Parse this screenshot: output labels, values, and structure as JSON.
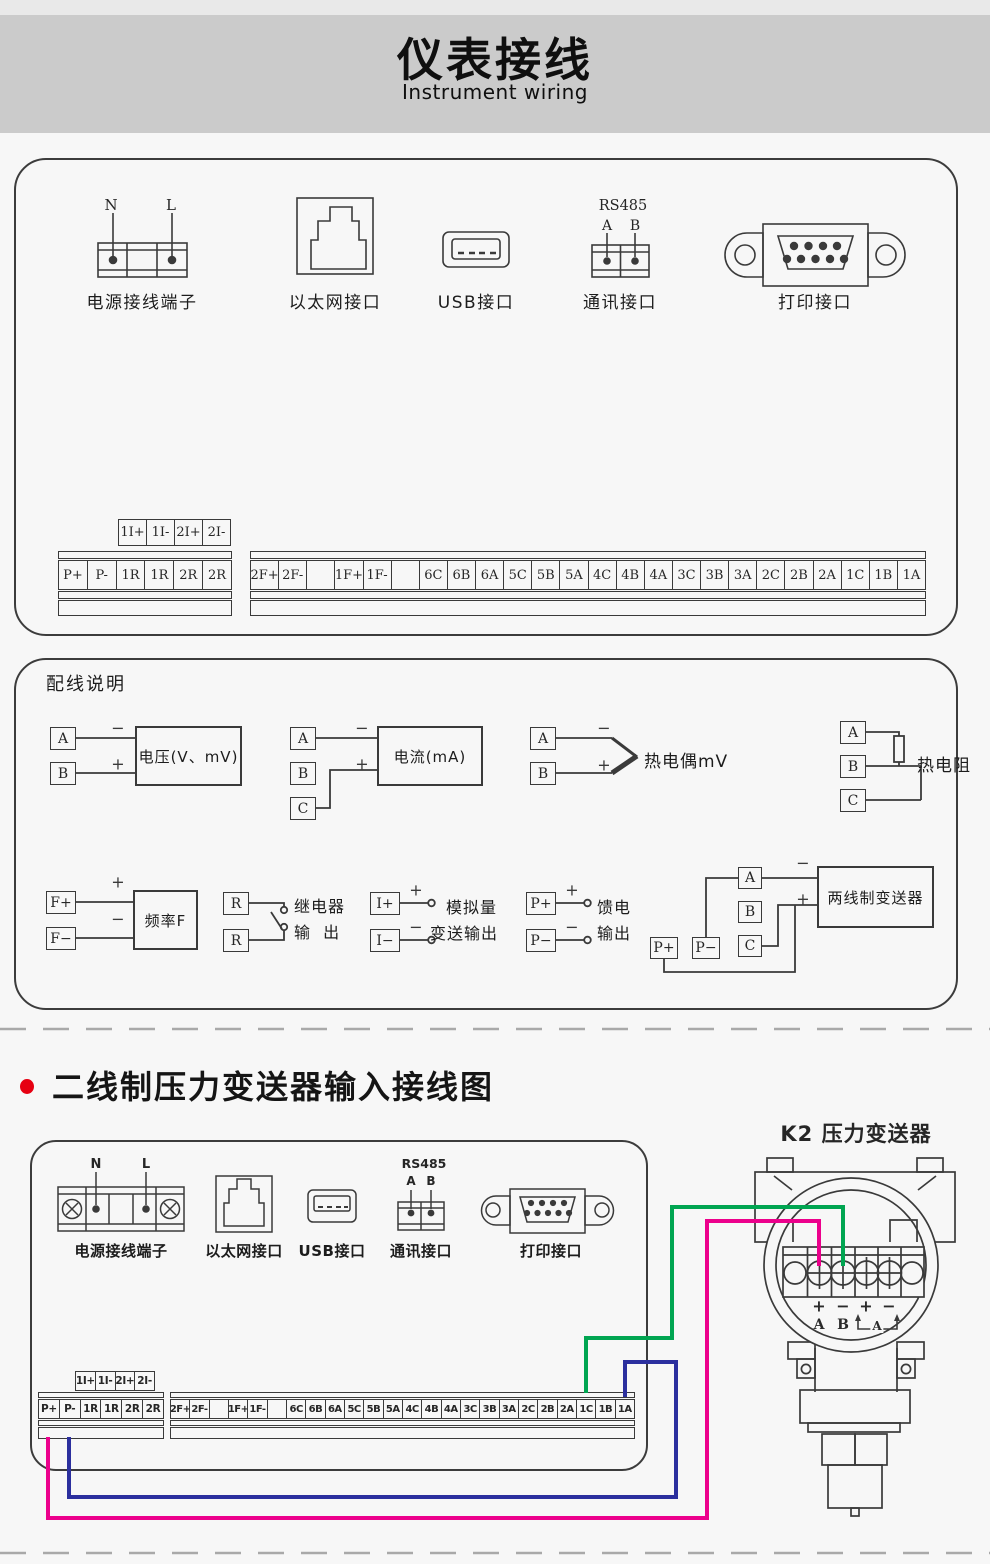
{
  "header": {
    "title": "仪表接线",
    "subtitle": "Instrument wiring"
  },
  "ports": {
    "power": {
      "label": "电源接线端子",
      "pin_n": "N",
      "pin_l": "L"
    },
    "ethernet": {
      "label": "以太网接口"
    },
    "usb": {
      "label": "USB接口"
    },
    "comm": {
      "label": "通讯接口",
      "bus": "RS485",
      "pin_a": "A",
      "pin_b": "B"
    },
    "printer": {
      "label": "打印接口"
    }
  },
  "terminal_strip": {
    "upper_row": [
      "1I+",
      "1I-",
      "2I+",
      "2I-"
    ],
    "left_block": [
      "P+",
      "P-",
      "1R",
      "1R",
      "2R",
      "2R"
    ],
    "right_block": [
      "2F+",
      "2F-",
      "",
      "1F+",
      "1F-",
      "",
      "6C",
      "6B",
      "6A",
      "5C",
      "5B",
      "5A",
      "4C",
      "4B",
      "4A",
      "3C",
      "3B",
      "3A",
      "2C",
      "2B",
      "2A",
      "1C",
      "1B",
      "1A"
    ]
  },
  "wiring_notes": {
    "title": "配线说明",
    "voltage": {
      "a": "A",
      "b": "B",
      "minus": "−",
      "plus": "+",
      "label": "电压(V、mV)"
    },
    "current": {
      "a": "A",
      "b": "B",
      "c": "C",
      "minus": "−",
      "plus": "+",
      "label": "电流(mA)"
    },
    "thermocouple": {
      "a": "A",
      "b": "B",
      "minus": "−",
      "plus": "+",
      "label": "热电偶mV"
    },
    "rtd": {
      "a": "A",
      "b": "B",
      "c": "C",
      "label": "热电阻"
    },
    "frequency": {
      "fp": "F+",
      "fm": "F−",
      "plus": "+",
      "minus": "−",
      "label": "频率F"
    },
    "relay": {
      "r1": "R",
      "r2": "R",
      "label_line1": "继电器",
      "label_line2": "输  出"
    },
    "analog_out": {
      "ip": "I+",
      "im": "I−",
      "plus": "+",
      "minus": "−",
      "label_line1": "模拟量",
      "label_line2": "变送输出"
    },
    "feed_out": {
      "pp": "P+",
      "pm": "P−",
      "plus": "+",
      "minus": "−",
      "label_line1": "馈电",
      "label_line2": "输出"
    },
    "two_wire": {
      "a": "A",
      "b": "B",
      "c": "C",
      "pp": "P+",
      "pm": "P−",
      "minus": "−",
      "plus": "+",
      "label": "两线制变送器"
    }
  },
  "section2": {
    "heading": "二线制压力变送器输入接线图"
  },
  "transmitter": {
    "title": "K2  压力变送器",
    "sign1": "+",
    "sign2": "−",
    "sign3": "+",
    "sign4": "−",
    "pin_a": "A",
    "pin_b": "B",
    "ammeter": "A"
  },
  "colors": {
    "wire_green": "#00a551",
    "wire_blue": "#2b2f9e",
    "wire_pink": "#ec008c",
    "bullet": "#e60012",
    "line": "#3a3a3a"
  }
}
